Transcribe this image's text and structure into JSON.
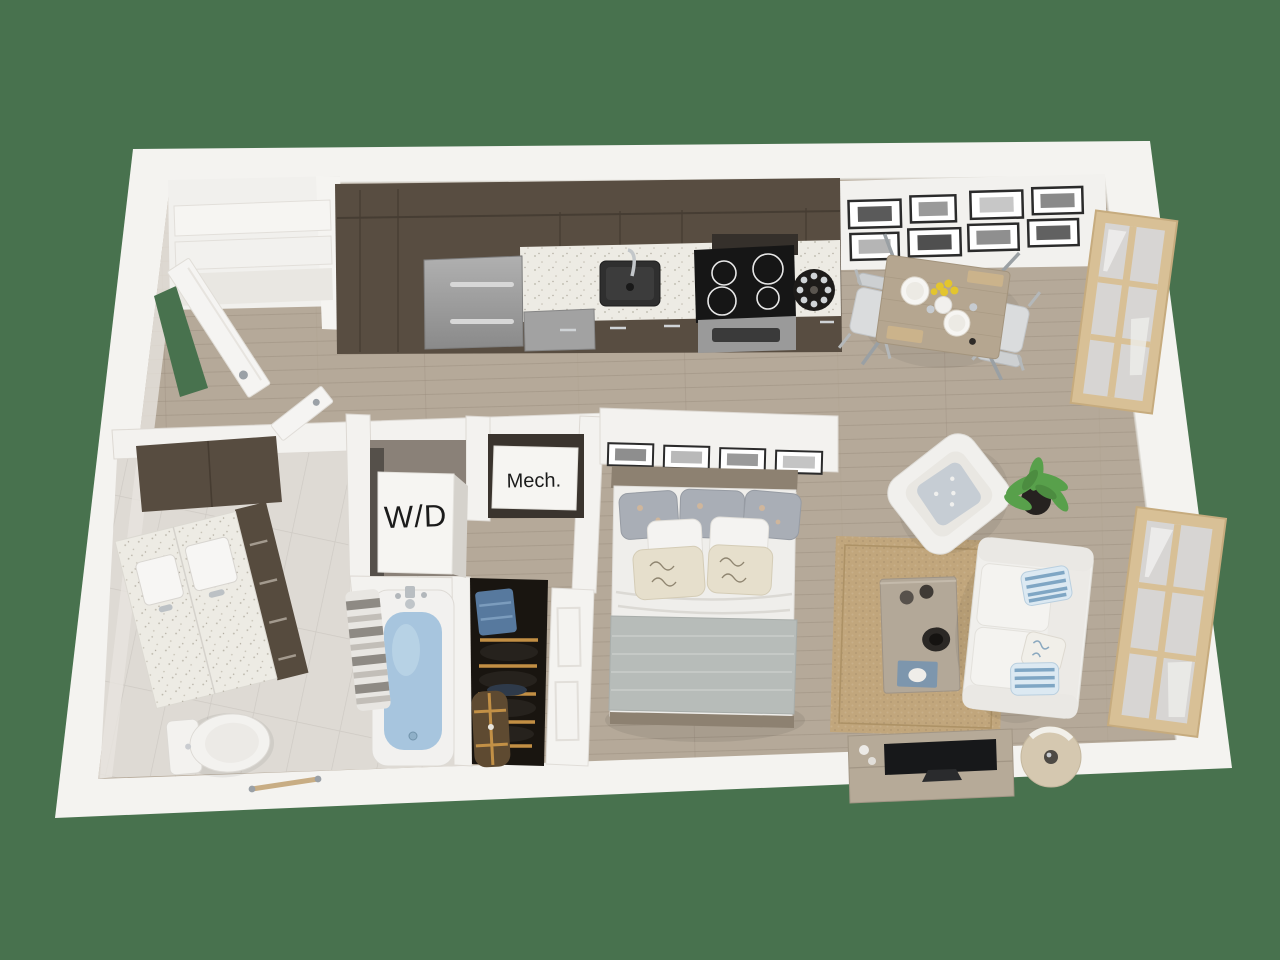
{
  "scene": {
    "title": "3D studio apartment floor plan, top-down view",
    "background_color": "#48724e",
    "labels": {
      "washer_dryer": "W/D",
      "mechanical": "Mech."
    },
    "palette": {
      "wall": "#f3f2ef",
      "wall_shadow": "#e0ddd8",
      "wood_floor": "#b5a999",
      "plank_line": "#998c7c",
      "tile_floor": "#dedad4",
      "grout_line": "#cbc7c1",
      "cabinet_dark": "#584d41",
      "counter": "#edebe4",
      "appliance_steel": "#9d9d9d",
      "cooktop_black": "#161616",
      "sink_dark": "#2f2f2f",
      "area_rug": "#c1a67c",
      "sofa_white": "#f0efec",
      "pillow_blue": "#7fa6c4",
      "bed_blanket": "#b7bcb9",
      "headboard_wood": "#8d8171",
      "tub_water": "#a7c5de",
      "plant_green": "#58a04b",
      "window_frame": "#d8c096",
      "lamp_shade": "#d5c8b0",
      "closet_dark": "#191510",
      "hanger_wood": "#c28f44",
      "denim_blue": "#57799e",
      "duffel_brown": "#5e4a31",
      "table_wood": "#b5a690",
      "chair_gray": "#d9dbdc",
      "flower_yellow": "#e3c52e",
      "frame_black": "#2b2b2b",
      "tv_black": "#17181a",
      "console_wood": "#b6aa98"
    },
    "rooms": [
      "entry",
      "kitchen",
      "dining-area",
      "living-area",
      "bedroom-area",
      "bathroom",
      "washer-dryer-closet",
      "mechanical-closet",
      "wardrobe-closet"
    ],
    "furniture": [
      "refrigerator",
      "dishwasher",
      "kitchen-sink",
      "cooktop-range",
      "microwave",
      "wine-caddy",
      "dining-table",
      "dining-chairs",
      "gallery-frames",
      "windows",
      "bed",
      "bed-wall-frames",
      "area-rug",
      "armchair",
      "potted-plant",
      "sofa",
      "coffee-table",
      "tv-console",
      "television",
      "floor-lamp",
      "bathtub",
      "shower-curtain",
      "vanity",
      "toilet",
      "towel-bar",
      "washer-dryer-unit",
      "wardrobe-clothes",
      "entry-door",
      "interior-doors",
      "entry-shelves"
    ]
  }
}
